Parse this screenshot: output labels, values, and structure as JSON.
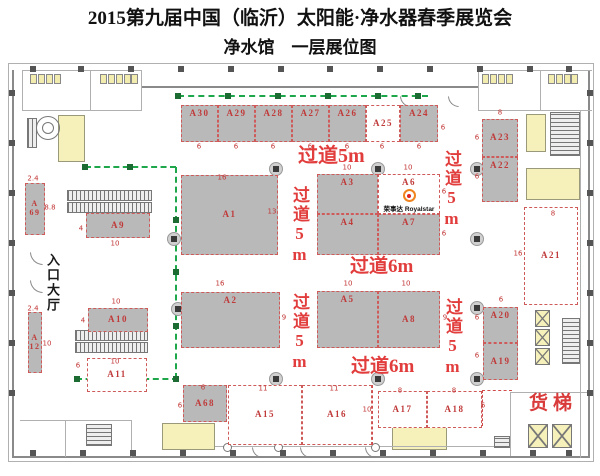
{
  "title": "2015第九届中国（临沂）太阳能·净水器春季展览会",
  "subtitle": "净水馆　一层展位图",
  "colors": {
    "booth_gray": "#b9b9b9",
    "booth_label_red": "#c03a3a",
    "aisle_red": "#e23d3d",
    "green_line": "#1ea64b",
    "yellow_zone": "#f6f1bb"
  },
  "logo": {
    "cn": "荣事达",
    "en": "Royalstar"
  },
  "texts": {
    "entrance": "入口大厅",
    "freight": "货梯"
  },
  "booths": [
    {
      "id": "A30",
      "x": 181,
      "y": 105,
      "w": 37,
      "h": 37,
      "f": "gray",
      "lp": "top"
    },
    {
      "id": "A29",
      "x": 218,
      "y": 105,
      "w": 37,
      "h": 37,
      "f": "gray",
      "lp": "top"
    },
    {
      "id": "A28",
      "x": 255,
      "y": 105,
      "w": 37,
      "h": 37,
      "f": "gray",
      "lp": "top"
    },
    {
      "id": "A27",
      "x": 292,
      "y": 105,
      "w": 37,
      "h": 37,
      "f": "gray",
      "lp": "top"
    },
    {
      "id": "A26",
      "x": 329,
      "y": 105,
      "w": 37,
      "h": 37,
      "f": "gray",
      "lp": "top"
    },
    {
      "id": "A25",
      "x": 366,
      "y": 105,
      "w": 34,
      "h": 37,
      "f": "white",
      "lp": "center"
    },
    {
      "id": "A24",
      "x": 400,
      "y": 105,
      "w": 38,
      "h": 37,
      "f": "gray",
      "lp": "top"
    },
    {
      "id": "A23",
      "x": 482,
      "y": 119,
      "w": 36,
      "h": 38,
      "f": "gray",
      "lp": "center"
    },
    {
      "id": "A22",
      "x": 482,
      "y": 157,
      "w": 36,
      "h": 45,
      "f": "gray",
      "lp": "top"
    },
    {
      "id": "A69",
      "x": 25,
      "y": 183,
      "w": 20,
      "h": 52,
      "f": "gray",
      "stack": "A\n69"
    },
    {
      "id": "A9",
      "x": 86,
      "y": 213,
      "w": 64,
      "h": 25,
      "f": "gray",
      "lp": "center"
    },
    {
      "id": "A1",
      "x": 181,
      "y": 175,
      "w": 97,
      "h": 80,
      "f": "gray",
      "lp": "center"
    },
    {
      "id": "A3",
      "x": 317,
      "y": 174,
      "w": 61,
      "h": 40,
      "f": "gray",
      "lp": "top"
    },
    {
      "id": "A6",
      "x": 378,
      "y": 174,
      "w": 62,
      "h": 40,
      "f": "white",
      "lp": "top",
      "logo": true
    },
    {
      "id": "A4",
      "x": 317,
      "y": 214,
      "w": 61,
      "h": 41,
      "f": "gray",
      "lp": "top"
    },
    {
      "id": "A7",
      "x": 378,
      "y": 214,
      "w": 62,
      "h": 41,
      "f": "gray",
      "lp": "top"
    },
    {
      "id": "A2",
      "x": 181,
      "y": 292,
      "w": 99,
      "h": 56,
      "f": "gray",
      "lp": "top"
    },
    {
      "id": "A5",
      "x": 317,
      "y": 291,
      "w": 61,
      "h": 57,
      "f": "gray",
      "lp": "top"
    },
    {
      "id": "A8",
      "x": 378,
      "y": 291,
      "w": 62,
      "h": 57,
      "f": "gray",
      "lp": "center"
    },
    {
      "id": "A10",
      "x": 88,
      "y": 308,
      "w": 60,
      "h": 24,
      "f": "gray",
      "lp": "center"
    },
    {
      "id": "A12",
      "x": 28,
      "y": 312,
      "w": 14,
      "h": 61,
      "f": "gray",
      "stack": "A\n12"
    },
    {
      "id": "A11",
      "x": 87,
      "y": 358,
      "w": 60,
      "h": 34,
      "f": "white",
      "lp": "center"
    },
    {
      "id": "A68",
      "x": 183,
      "y": 385,
      "w": 44,
      "h": 37,
      "f": "gray",
      "lp": "center"
    },
    {
      "id": "A15",
      "x": 228,
      "y": 385,
      "w": 74,
      "h": 60,
      "f": "white",
      "lp": "center"
    },
    {
      "id": "A16",
      "x": 302,
      "y": 385,
      "w": 70,
      "h": 60,
      "f": "white",
      "lp": "center"
    },
    {
      "id": "A17",
      "x": 378,
      "y": 391,
      "w": 49,
      "h": 37,
      "f": "white",
      "lp": "center"
    },
    {
      "id": "A18",
      "x": 427,
      "y": 391,
      "w": 55,
      "h": 37,
      "f": "white",
      "lp": "center"
    },
    {
      "id": "A20",
      "x": 483,
      "y": 307,
      "w": 35,
      "h": 36,
      "f": "gray",
      "lp": "top"
    },
    {
      "id": "A19",
      "x": 483,
      "y": 343,
      "w": 35,
      "h": 37,
      "f": "gray",
      "lp": "center"
    },
    {
      "id": "A21",
      "x": 524,
      "y": 207,
      "w": 54,
      "h": 98,
      "f": "white",
      "lp": "center"
    }
  ],
  "aisles": [
    {
      "t": "过道5m",
      "x": 298,
      "y": 146,
      "s": 20,
      "v": false
    },
    {
      "t": "过道5m",
      "x": 291,
      "y": 186,
      "s": 17,
      "v": true
    },
    {
      "t": "过道5m",
      "x": 443,
      "y": 150,
      "s": 17,
      "v": true
    },
    {
      "t": "过道6m",
      "x": 350,
      "y": 257,
      "s": 19,
      "v": false
    },
    {
      "t": "过道5m",
      "x": 291,
      "y": 293,
      "s": 17,
      "v": true
    },
    {
      "t": "过道5m",
      "x": 444,
      "y": 298,
      "s": 17,
      "v": true
    },
    {
      "t": "过道6m",
      "x": 351,
      "y": 357,
      "s": 19,
      "v": false
    }
  ],
  "dims": [
    [
      "6",
      199,
      147
    ],
    [
      "6",
      236,
      147
    ],
    [
      "6",
      273,
      147
    ],
    [
      "6",
      310,
      147
    ],
    [
      "6",
      347,
      147
    ],
    [
      "6",
      382,
      147
    ],
    [
      "6",
      419,
      147
    ],
    [
      "6",
      443,
      128
    ],
    [
      "8",
      500,
      113
    ],
    [
      "6",
      477,
      138
    ],
    [
      "6",
      477,
      177
    ],
    [
      "16",
      222,
      178
    ],
    [
      "13",
      272,
      212
    ],
    [
      "10",
      347,
      168
    ],
    [
      "10",
      408,
      168
    ],
    [
      "6",
      444,
      192
    ],
    [
      "6",
      444,
      234
    ],
    [
      "2.4",
      33,
      179
    ],
    [
      "8.8",
      50,
      208
    ],
    [
      "4",
      81,
      229
    ],
    [
      "10",
      115,
      244
    ],
    [
      "16",
      220,
      284
    ],
    [
      "9",
      284,
      318
    ],
    [
      "10",
      348,
      284
    ],
    [
      "10",
      406,
      284
    ],
    [
      "9",
      445,
      318
    ],
    [
      "8",
      553,
      214
    ],
    [
      "16",
      518,
      254
    ],
    [
      "10",
      116,
      302
    ],
    [
      "4",
      83,
      321
    ],
    [
      "2.4",
      33,
      309
    ],
    [
      "10",
      47,
      344
    ],
    [
      "10",
      115,
      362
    ],
    [
      "6",
      78,
      366
    ],
    [
      "6",
      501,
      300
    ],
    [
      "6",
      477,
      318
    ],
    [
      "6",
      477,
      356
    ],
    [
      "6",
      203,
      388
    ],
    [
      "6",
      180,
      406
    ],
    [
      "11",
      263,
      389
    ],
    [
      "11",
      334,
      389
    ],
    [
      "10",
      367,
      410
    ],
    [
      "8",
      400,
      391
    ],
    [
      "8",
      454,
      391
    ],
    [
      "6",
      483,
      406
    ]
  ],
  "green": {
    "segments": [
      {
        "x": 178,
        "y": 96,
        "len": 250,
        "o": "h"
      },
      {
        "x": 85,
        "y": 167,
        "len": 91,
        "o": "h"
      },
      {
        "x": 176,
        "y": 167,
        "len": 212,
        "o": "v"
      },
      {
        "x": 76,
        "y": 379,
        "len": 102,
        "o": "h"
      }
    ],
    "markers": [
      [
        178,
        96
      ],
      [
        228,
        96
      ],
      [
        278,
        96
      ],
      [
        328,
        96
      ],
      [
        378,
        96
      ],
      [
        418,
        96
      ],
      [
        85,
        167
      ],
      [
        130,
        167
      ],
      [
        176,
        220
      ],
      [
        176,
        272
      ],
      [
        176,
        326
      ],
      [
        77,
        379
      ],
      [
        125,
        379
      ],
      [
        176,
        379
      ]
    ]
  },
  "columns": [
    [
      275,
      168
    ],
    [
      377,
      168
    ],
    [
      476,
      168
    ],
    [
      173,
      238
    ],
    [
      476,
      238
    ],
    [
      177,
      308
    ],
    [
      476,
      307
    ],
    [
      275,
      378
    ],
    [
      377,
      378
    ],
    [
      476,
      378
    ]
  ],
  "wall_columns": {
    "top": {
      "y": 66,
      "xs": [
        30,
        78,
        128,
        178,
        228,
        278,
        327,
        377,
        427,
        477,
        527,
        566
      ]
    },
    "bottom": {
      "y": 450,
      "xs": [
        30,
        80,
        130,
        180,
        230,
        280,
        330,
        380,
        430,
        480,
        530,
        566
      ]
    },
    "left": {
      "x": 9,
      "ys": [
        90,
        140,
        190,
        240,
        290,
        340,
        390
      ]
    },
    "right": {
      "x": 587,
      "ys": [
        90,
        140,
        190,
        240,
        290,
        340,
        390
      ]
    }
  },
  "fixtures": [
    {
      "y": 74,
      "xs": [
        30,
        38,
        46,
        54
      ]
    },
    {
      "y": 74,
      "xs": [
        100,
        108,
        116,
        124,
        131
      ]
    },
    {
      "y": 74,
      "xs": [
        482,
        490,
        498,
        506
      ]
    },
    {
      "y": 74,
      "xs": [
        548,
        556,
        564,
        571
      ]
    }
  ],
  "shapes": [
    {
      "c": "thin",
      "n": "outer-boundary",
      "x": 8,
      "y": 63,
      "w": 586,
      "h": 1
    },
    {
      "c": "thin",
      "n": "outer-boundary",
      "x": 8,
      "y": 63,
      "w": 1,
      "h": 399
    },
    {
      "c": "thin",
      "n": "outer-boundary",
      "x": 593,
      "y": 63,
      "w": 1,
      "h": 399
    },
    {
      "c": "thin",
      "n": "outer-boundary",
      "x": 8,
      "y": 461,
      "w": 586,
      "h": 1
    },
    {
      "c": "wall-h",
      "n": "top-wall",
      "x": 142,
      "y": 86,
      "w": 336,
      "h": 2
    },
    {
      "c": "wall-v",
      "n": "left-wall",
      "x": 12,
      "y": 70,
      "w": 2,
      "h": 388
    },
    {
      "c": "wall-v",
      "n": "right-wall",
      "x": 588,
      "y": 70,
      "w": 2,
      "h": 388
    },
    {
      "c": "wall-h",
      "n": "bottom-wall",
      "x": 14,
      "y": 456,
      "w": 576,
      "h": 2
    },
    {
      "c": "thin",
      "n": "restroom-wall",
      "x": 22,
      "y": 70,
      "w": 120,
      "h": 1
    },
    {
      "c": "thin",
      "n": "restroom-wall",
      "x": 22,
      "y": 70,
      "w": 1,
      "h": 41
    },
    {
      "c": "thin",
      "n": "restroom-wall",
      "x": 22,
      "y": 110,
      "w": 120,
      "h": 1
    },
    {
      "c": "thin",
      "n": "restroom-wall",
      "x": 141,
      "y": 70,
      "w": 1,
      "h": 41
    },
    {
      "c": "thin",
      "n": "restroom-wall",
      "x": 90,
      "y": 70,
      "w": 1,
      "h": 40
    },
    {
      "c": "thin",
      "n": "restroom-wall",
      "x": 478,
      "y": 70,
      "w": 114,
      "h": 1
    },
    {
      "c": "thin",
      "n": "restroom-wall",
      "x": 478,
      "y": 70,
      "w": 1,
      "h": 41
    },
    {
      "c": "thin",
      "n": "restroom-wall",
      "x": 478,
      "y": 110,
      "w": 114,
      "h": 1
    },
    {
      "c": "thin",
      "n": "restroom-wall",
      "x": 540,
      "y": 70,
      "w": 1,
      "h": 40
    },
    {
      "c": "yellow",
      "n": "stair-lobby",
      "x": 58,
      "y": 115,
      "w": 27,
      "h": 47
    },
    {
      "c": "ring",
      "n": "spiral-stair",
      "x": 36,
      "y": 116,
      "w": 24,
      "h": 24
    },
    {
      "c": "ring",
      "n": "spiral-stair",
      "x": 42,
      "y": 122,
      "w": 12,
      "h": 12
    },
    {
      "c": "hatch-v",
      "n": "stair-hatch",
      "x": 27,
      "y": 118,
      "w": 10,
      "h": 30
    },
    {
      "c": "hatch-v",
      "n": "escalator-lane",
      "x": 67,
      "y": 190,
      "w": 85,
      "h": 11
    },
    {
      "c": "hatch-v",
      "n": "escalator-lane",
      "x": 67,
      "y": 202,
      "w": 85,
      "h": 11
    },
    {
      "c": "hatch-v",
      "n": "escalator-lane",
      "x": 75,
      "y": 330,
      "w": 73,
      "h": 11
    },
    {
      "c": "hatch-v",
      "n": "escalator-lane",
      "x": 75,
      "y": 342,
      "w": 73,
      "h": 11
    },
    {
      "c": "arc",
      "n": "door-arc",
      "x": 30,
      "y": 252,
      "w": 13,
      "h": 13
    },
    {
      "c": "arc",
      "n": "door-arc",
      "x": 30,
      "y": 280,
      "w": 13,
      "h": 13
    },
    {
      "c": "thin",
      "n": "room-wall",
      "x": 20,
      "y": 420,
      "w": 112,
      "h": 1
    },
    {
      "c": "thin",
      "n": "room-wall",
      "x": 65,
      "y": 420,
      "w": 1,
      "h": 37
    },
    {
      "c": "thin",
      "n": "room-wall",
      "x": 131,
      "y": 420,
      "w": 1,
      "h": 37
    },
    {
      "c": "hatch-h",
      "n": "stair-hatch",
      "x": 86,
      "y": 424,
      "w": 26,
      "h": 22
    },
    {
      "c": "yellow",
      "n": "room",
      "x": 162,
      "y": 423,
      "w": 53,
      "h": 27
    },
    {
      "c": "yellow",
      "n": "room",
      "x": 392,
      "y": 422,
      "w": 55,
      "h": 28
    },
    {
      "c": "thin",
      "n": "inner-bottom-wall",
      "x": 215,
      "y": 446,
      "w": 295,
      "h": 1
    },
    {
      "c": "wcircle",
      "n": "wall-column-round",
      "x": 223,
      "y": 443,
      "w": 9,
      "h": 9
    },
    {
      "c": "wcircle",
      "n": "wall-column-round",
      "x": 274,
      "y": 443,
      "w": 9,
      "h": 9
    },
    {
      "c": "wcircle",
      "n": "wall-column-round",
      "x": 371,
      "y": 443,
      "w": 9,
      "h": 9
    },
    {
      "c": "hatch-h",
      "n": "stair-hatch",
      "x": 550,
      "y": 112,
      "w": 30,
      "h": 44
    },
    {
      "c": "yellow",
      "n": "elevator-lobby",
      "x": 526,
      "y": 114,
      "w": 20,
      "h": 38
    },
    {
      "c": "yellow",
      "n": "room",
      "x": 526,
      "y": 168,
      "w": 54,
      "h": 32
    },
    {
      "c": "thin",
      "n": "right-inner-wall",
      "x": 580,
      "y": 110,
      "w": 1,
      "h": 348
    },
    {
      "c": "xbox",
      "n": "elevator",
      "x": 535,
      "y": 310,
      "w": 15,
      "h": 17
    },
    {
      "c": "xbox",
      "n": "elevator",
      "x": 535,
      "y": 329,
      "w": 15,
      "h": 17
    },
    {
      "c": "xbox",
      "n": "elevator",
      "x": 535,
      "y": 348,
      "w": 15,
      "h": 17
    },
    {
      "c": "hatch-h",
      "n": "stair-hatch",
      "x": 562,
      "y": 318,
      "w": 18,
      "h": 46
    },
    {
      "c": "thin",
      "n": "freight-room-wall",
      "x": 510,
      "y": 392,
      "w": 80,
      "h": 1
    },
    {
      "c": "thin",
      "n": "freight-room-wall",
      "x": 510,
      "y": 392,
      "w": 1,
      "h": 64
    },
    {
      "c": "xbox",
      "n": "freight-elevator",
      "x": 528,
      "y": 424,
      "w": 20,
      "h": 24
    },
    {
      "c": "xbox",
      "n": "freight-elevator",
      "x": 552,
      "y": 424,
      "w": 20,
      "h": 24
    },
    {
      "c": "hatch-h",
      "n": "stair-hatch",
      "x": 494,
      "y": 436,
      "w": 16,
      "h": 12
    },
    {
      "c": "rdash-v",
      "n": "aisle-dash",
      "x": 372,
      "y": 385,
      "w": 0,
      "h": 60
    },
    {
      "c": "rdash-v",
      "n": "aisle-dash",
      "x": 482,
      "y": 390,
      "w": 0,
      "h": 36
    },
    {
      "c": "rdash-h",
      "n": "aisle-dash",
      "x": 482,
      "y": 390,
      "w": 30,
      "h": 0
    },
    {
      "c": "arc",
      "n": "door-arc",
      "x": 400,
      "y": 96,
      "w": 11,
      "h": 11
    },
    {
      "c": "arc",
      "n": "door-arc",
      "x": 448,
      "y": 96,
      "w": 11,
      "h": 11
    },
    {
      "c": "arc",
      "n": "door-arc",
      "x": 252,
      "y": 447,
      "w": 11,
      "h": 11
    },
    {
      "c": "arc",
      "n": "door-arc",
      "x": 300,
      "y": 447,
      "w": 11,
      "h": 11
    },
    {
      "c": "arc",
      "n": "door-arc",
      "x": 365,
      "y": 447,
      "w": 11,
      "h": 11
    }
  ],
  "entrance_pos": {
    "x": 46,
    "y": 253,
    "s": 13
  },
  "freight_pos": {
    "x": 529,
    "y": 394
  }
}
